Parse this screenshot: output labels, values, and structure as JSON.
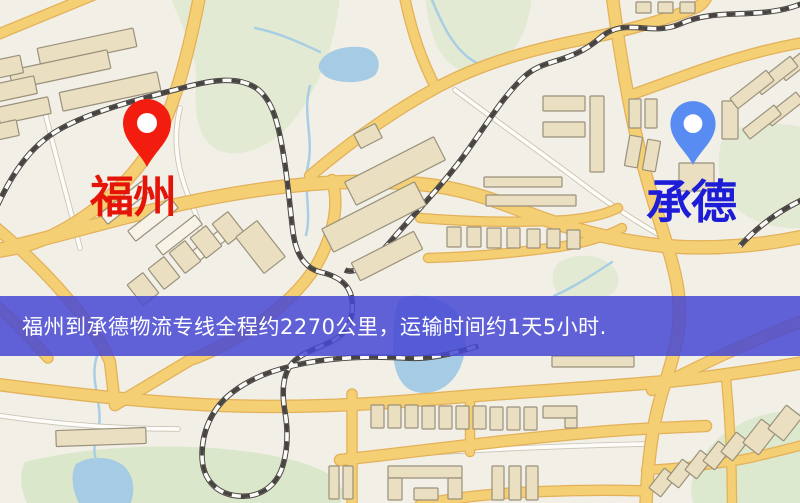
{
  "banner": {
    "text": "福州到承德物流专线全程约2270公里，运输时间约1天5小时.",
    "bg": "rgba(70,72,212,0.85)",
    "text_color": "#ffffff",
    "top": 296,
    "height": 60,
    "pad_left": 22,
    "font_size": 21
  },
  "markers": [
    {
      "id": "fuzhou",
      "label": "福州",
      "label_color": "#e41408",
      "pin_color": "#f21d0e",
      "tip_x": 147,
      "tip_y": 167,
      "scale": 1.0,
      "label_left": 90,
      "label_top": 176,
      "label_font": 44
    },
    {
      "id": "chengde",
      "label": "承德",
      "label_color": "#1d1dd8",
      "pin_color": "#588cf2",
      "tip_x": 693,
      "tip_y": 165,
      "scale": 0.94,
      "label_left": 646,
      "label_top": 179,
      "label_font": 46
    }
  ],
  "map": {
    "bg": "#f2efe6",
    "palette": {
      "park": "#e2ead4",
      "water": "#a6cbe4",
      "stream": "#a9cee3",
      "road_major_fill": "#f4cf74",
      "road_major_casing": "#e3b159",
      "road_minor_fill": "#fdfcf8",
      "road_minor_casing": "#c9c3b4",
      "rail_dark": "#474340",
      "rail_light": "#fbfaf7",
      "building_fill": "#eadfc0",
      "building_fill_alt": "#f7f3e7",
      "building_stroke": "#9a917d",
      "pin_hole": "#ffffff"
    },
    "parks": [
      {
        "d": "M170,-5 L340,-5 C336,40 322,80 300,112 C278,143 248,158 224,152 C203,147 193,123 196,86 C199,54 178,20 170,-5 Z"
      },
      {
        "d": "M425,-5 L532,-5 C530,22 520,46 504,60 C488,74 462,76 448,62 C434,48 428,24 425,-5 Z"
      },
      {
        "d": "M725,132 C755,122 782,122 806,128 L806,228 C772,230 742,220 728,198 C716,179 716,152 725,132 Z"
      },
      {
        "d": "M560,262 C578,252 600,254 612,266 C622,276 620,290 608,296 L560,296 C550,286 550,270 560,262 Z"
      },
      {
        "d": "M25,462 C80,448 155,443 225,449 C285,455 322,466 338,481 C344,490 344,498 339,505 L28,505 C20,490 19,473 25,462 Z",
        "f": "#dbe7cb"
      },
      {
        "d": "M702,458 C718,432 748,416 778,412 C790,410 800,412 806,415 L806,505 L694,505 C688,488 692,472 702,458 Z",
        "f": "#dde9ce"
      }
    ],
    "water": [
      {
        "d": "M320,62 C326,50 348,44 366,48 C378,52 382,64 376,74 C366,85 336,84 325,76 C319,71 317,67 320,62 Z"
      },
      {
        "d": "M400,298 C422,292 446,298 458,314 C468,328 468,352 459,370 C450,388 432,396 416,392 C400,388 393,370 393,348 C393,328 395,308 400,298 Z"
      },
      {
        "d": "M76,464 C90,455 112,456 124,466 C134,476 136,491 130,505 L80,505 C72,491 70,474 76,464 Z"
      }
    ],
    "streams": [
      {
        "d": "M255,28 C275,32 295,40 320,52"
      },
      {
        "d": "M430,-5 C442,25 455,52 477,63 C492,70 508,66 518,52"
      },
      {
        "d": "M310,86 C302,112 314,138 308,165 C303,188 312,212 306,235"
      },
      {
        "d": "M97,356 C88,382 106,408 97,434 C92,450 95,460 100,470"
      },
      {
        "d": "M612,262 C600,270 585,280 570,288 C563,292 558,294 554,296"
      }
    ],
    "roads_minor": [
      {
        "d": "M42,100 C54,150 68,200 80,248"
      },
      {
        "d": "M-5,110 L44,101"
      },
      {
        "d": "M455,90 C495,120 540,152 580,182 C610,205 640,224 668,240"
      },
      {
        "d": "M-5,415 C55,424 115,429 178,429"
      },
      {
        "d": "M395,455 C470,450 555,446 645,444"
      },
      {
        "d": "M180,108 C172,140 178,172 190,200 C196,214 200,225 202,238"
      }
    ],
    "roads_major": [
      {
        "d": "M-6,36 L96,-6",
        "w": 9
      },
      {
        "d": "M200,-6 C190,45 178,95 160,132 C138,178 90,220 42,240 C27,246 10,250 -6,252",
        "w": 11
      },
      {
        "d": "M-6,251 C60,236 130,214 200,200 C280,184 350,178 420,184 C460,188 490,198 525,212 C565,228 615,241 665,246 C715,250 765,245 806,236",
        "w": 12
      },
      {
        "d": "M-6,226 C25,252 57,284 82,316 C95,333 103,345 110,362 L115,405",
        "w": 10
      },
      {
        "d": "M332,180 C340,205 333,237 316,266 C300,292 272,315 246,332 C225,345 205,355 190,360 L115,405",
        "w": 10
      },
      {
        "d": "M48,358 C32,340 12,318 -6,304",
        "w": 9
      },
      {
        "d": "M-6,384 C80,395 160,404 240,406 C330,408 400,402 470,396 C560,389 640,385 700,378 C745,372 780,367 806,362",
        "w": 11
      },
      {
        "d": "M340,460 C430,450 520,438 610,431 C650,428 680,427 706,426",
        "w": 10
      },
      {
        "d": "M420,505 C460,496 510,492 560,491 C590,490 620,490 645,491",
        "w": 9
      },
      {
        "d": "M352,394 L352,505",
        "w": 9
      },
      {
        "d": "M470,396 L470,452",
        "w": 8
      },
      {
        "d": "M612,-6 C620,55 630,115 644,168 C652,198 660,222 668,248 C674,268 678,285 679,300 C681,330 674,355 666,380 C655,412 648,450 646,505",
        "w": 11
      },
      {
        "d": "M652,390 C690,370 730,351 770,334 C782,329 795,324 806,320",
        "w": 10
      },
      {
        "d": "M806,42 C770,48 735,58 700,70 C675,79 650,88 628,96",
        "w": 9
      },
      {
        "d": "M310,176 C350,142 392,112 436,88 C480,64 530,50 580,40 C620,32 660,22 695,8 C700,6 704,3 708,-6",
        "w": 10
      },
      {
        "d": "M404,-6 C410,25 420,58 436,88",
        "w": 9
      },
      {
        "d": "M420,218 C470,222 520,223 568,220 C590,218 606,214 618,208",
        "w": 8
      },
      {
        "d": "M428,258 C470,257 515,253 558,247 C585,243 605,237 622,228",
        "w": 8
      },
      {
        "d": "M726,378 C730,420 732,462 732,505",
        "w": 8
      },
      {
        "d": "M646,470 C680,468 715,465 750,458 C775,452 792,448 806,444",
        "w": 8
      }
    ],
    "railways": [
      {
        "d": "M-6,213 C12,172 32,144 62,128 C95,110 140,99 186,87 C212,80 238,76 256,88 C272,99 278,122 283,152 C288,180 290,210 293,232 C296,255 305,268 320,272 C338,276 350,284 352,300 C354,318 348,332 334,340 C318,349 300,352 290,366 C282,378 282,395 285,412 C288,430 288,448 283,465 C277,486 260,498 238,496 C216,494 202,479 202,455 C202,431 212,410 228,396 C244,382 266,372 292,366 C330,357 368,356 404,358 C428,360 452,354 478,346"
      },
      {
        "d": "M806,2 C760,22 720,6 680,24 C650,37 625,16 600,38 C570,64 545,58 525,76 C505,94 488,122 468,150 C444,184 414,214 390,242 C372,263 355,275 345,270"
      },
      {
        "d": "M806,198 C780,210 758,226 740,246"
      }
    ],
    "buildings": [
      [
        38,
        38,
        98,
        19,
        -12
      ],
      [
        10,
        60,
        100,
        19,
        -12
      ],
      [
        60,
        82,
        100,
        19,
        -12
      ],
      [
        -8,
        58,
        30,
        18,
        -12
      ],
      [
        -6,
        80,
        42,
        18,
        -12
      ],
      [
        -2,
        102,
        52,
        17,
        -12
      ],
      [
        -6,
        122,
        24,
        16,
        -12
      ],
      [
        98,
        196,
        54,
        13,
        -38,
        1
      ],
      [
        126,
        213,
        54,
        13,
        -38,
        1
      ],
      [
        154,
        229,
        50,
        12,
        -38,
        1
      ],
      [
        183,
        242,
        46,
        12,
        -38,
        1
      ],
      [
        345,
        158,
        100,
        26,
        -27
      ],
      [
        322,
        204,
        104,
        26,
        -27
      ],
      [
        352,
        246,
        70,
        20,
        -27
      ],
      [
        356,
        128,
        24,
        16,
        -27
      ],
      [
        133,
        276,
        20,
        26,
        -38
      ],
      [
        154,
        260,
        20,
        26,
        -38
      ],
      [
        175,
        244,
        20,
        26,
        -38
      ],
      [
        196,
        229,
        20,
        26,
        -38
      ],
      [
        218,
        215,
        20,
        26,
        -38
      ],
      [
        247,
        224,
        27,
        46,
        -38
      ],
      [
        543,
        96,
        42,
        15,
        0
      ],
      [
        543,
        122,
        42,
        15,
        0
      ],
      [
        590,
        96,
        14,
        76,
        0
      ],
      [
        484,
        177,
        78,
        10,
        0
      ],
      [
        486,
        195,
        90,
        11,
        0
      ],
      [
        447,
        227,
        14,
        20,
        0
      ],
      [
        467,
        227,
        14,
        20,
        0
      ],
      [
        487,
        228,
        14,
        20,
        0
      ],
      [
        507,
        228,
        13,
        20,
        0
      ],
      [
        527,
        229,
        13,
        19,
        0
      ],
      [
        547,
        229,
        13,
        19,
        0
      ],
      [
        567,
        230,
        13,
        19,
        0
      ],
      [
        636,
        2,
        15,
        11,
        0
      ],
      [
        658,
        2,
        15,
        11,
        0
      ],
      [
        680,
        2,
        15,
        11,
        0
      ],
      [
        629,
        99,
        12,
        29,
        0
      ],
      [
        645,
        99,
        12,
        29,
        0
      ],
      [
        627,
        136,
        13,
        31,
        10
      ],
      [
        645,
        140,
        13,
        31,
        10
      ],
      [
        679,
        163,
        35,
        28,
        0
      ],
      [
        722,
        101,
        16,
        38,
        0
      ],
      [
        777,
        55,
        46,
        13,
        -38
      ],
      [
        753,
        69,
        46,
        13,
        -38
      ],
      [
        729,
        83,
        46,
        13,
        -38
      ],
      [
        764,
        103,
        40,
        12,
        -38
      ],
      [
        742,
        116,
        40,
        12,
        -38
      ],
      [
        552,
        356,
        82,
        11,
        0
      ],
      [
        371,
        405,
        13,
        23,
        0
      ],
      [
        388,
        405,
        13,
        23,
        0
      ],
      [
        405,
        405,
        13,
        23,
        0
      ],
      [
        422,
        406,
        13,
        23,
        0
      ],
      [
        439,
        406,
        13,
        23,
        0
      ],
      [
        456,
        406,
        13,
        23,
        0
      ],
      [
        473,
        406,
        13,
        23,
        0
      ],
      [
        490,
        407,
        13,
        23,
        0
      ],
      [
        507,
        407,
        13,
        23,
        0
      ],
      [
        524,
        407,
        13,
        23,
        0
      ],
      [
        543,
        406,
        34,
        12,
        0
      ],
      [
        565,
        418,
        12,
        10,
        0
      ],
      [
        388,
        466,
        74,
        12,
        0
      ],
      [
        388,
        478,
        14,
        22,
        0
      ],
      [
        448,
        478,
        14,
        21,
        0
      ],
      [
        414,
        488,
        24,
        12,
        0
      ],
      [
        492,
        466,
        12,
        34,
        0
      ],
      [
        509,
        466,
        12,
        34,
        0
      ],
      [
        526,
        466,
        12,
        34,
        0
      ],
      [
        56,
        429,
        90,
        16,
        -2
      ],
      [
        329,
        466,
        10,
        33,
        0
      ],
      [
        343,
        466,
        10,
        33,
        0
      ],
      [
        655,
        470,
        15,
        25,
        38
      ],
      [
        673,
        461,
        15,
        25,
        38
      ],
      [
        691,
        452,
        15,
        25,
        38
      ],
      [
        709,
        443,
        15,
        25,
        38
      ],
      [
        727,
        434,
        15,
        25,
        38
      ],
      [
        750,
        422,
        20,
        30,
        38
      ],
      [
        775,
        408,
        20,
        30,
        38
      ]
    ]
  }
}
